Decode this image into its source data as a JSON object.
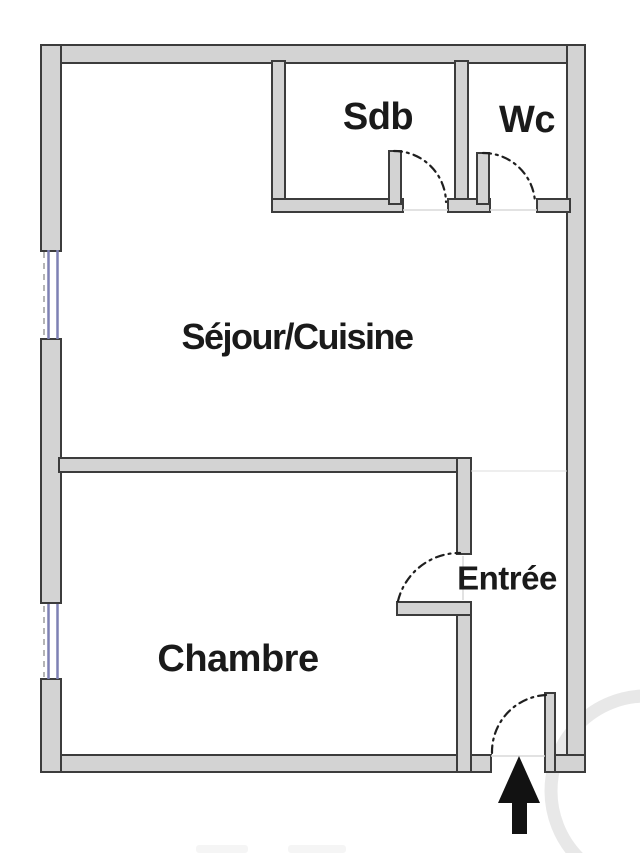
{
  "rooms": [
    {
      "id": "sdb",
      "label": "Sdb"
    },
    {
      "id": "wc",
      "label": "Wc"
    },
    {
      "id": "sejour_cuisine",
      "label": "Séjour/Cuisine"
    },
    {
      "id": "entree",
      "label": "Entrée"
    },
    {
      "id": "chambre",
      "label": "Chambre"
    }
  ],
  "colors": {
    "background": "#ffffff",
    "wall_fill": "#d3d3d3",
    "wall_outline": "#3c3c3c",
    "window_frame": "#7e81b4",
    "window_dash": "#b5b5b5",
    "door_swing": "#1f1f1f",
    "label_text": "#1a1a1a",
    "entrance_arrow": "#121212",
    "watermark": "#c9c9c9"
  }
}
